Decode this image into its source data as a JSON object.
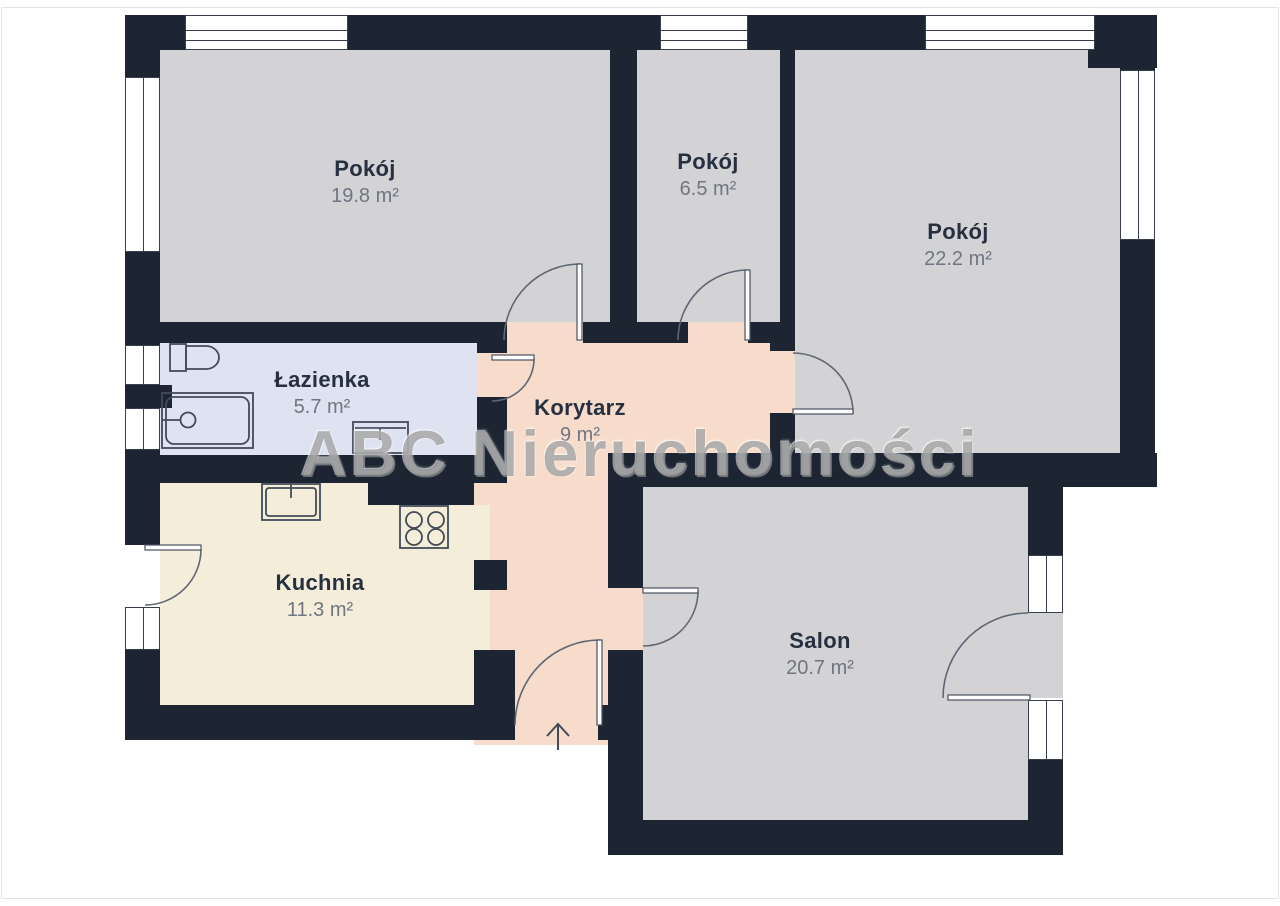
{
  "watermark": "ABC Nieruchomości",
  "rooms": [
    {
      "id": "pokoj-1",
      "name": "Pokój",
      "area": "19.8 m²"
    },
    {
      "id": "pokoj-2",
      "name": "Pokój",
      "area": "6.5 m²"
    },
    {
      "id": "pokoj-3",
      "name": "Pokój",
      "area": "22.2 m²"
    },
    {
      "id": "lazienka",
      "name": "Łazienka",
      "area": "5.7 m²"
    },
    {
      "id": "korytarz",
      "name": "Korytarz",
      "area": "9 m²"
    },
    {
      "id": "kuchnia",
      "name": "Kuchnia",
      "area": "11.3 m²"
    },
    {
      "id": "salon",
      "name": "Salon",
      "area": "20.7 m²"
    }
  ],
  "colors": {
    "wall": "#1c2531",
    "room-gray": "#d3d3d5",
    "room-bath": "#dee2f1",
    "room-kitchen": "#f4edda",
    "room-corridor": "#f7dccc",
    "label-name": "#273040",
    "label-area": "#6f7681"
  }
}
